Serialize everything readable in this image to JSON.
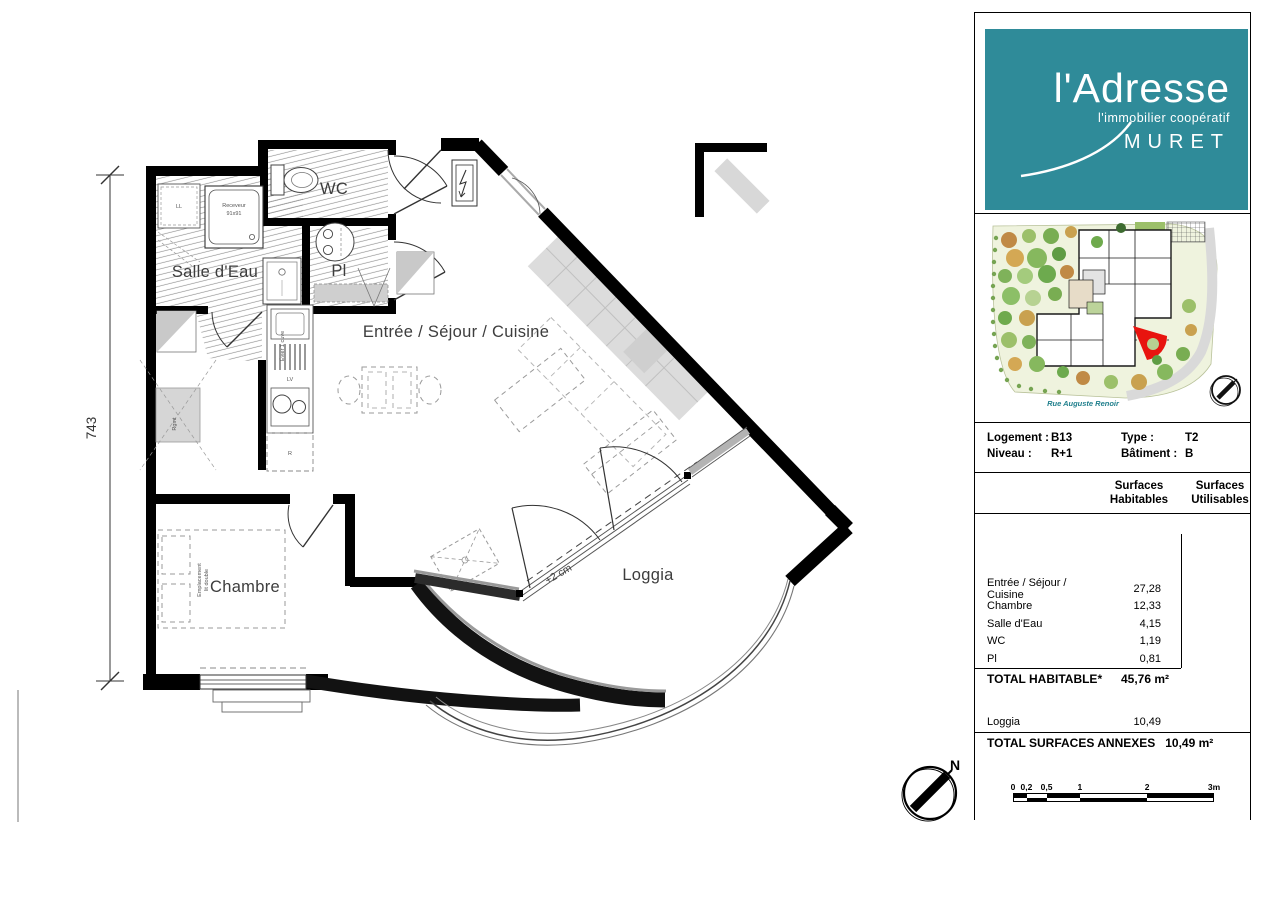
{
  "colors": {
    "brand_teal": "#2f8b99",
    "accent_red": "#e8140f",
    "street_teal": "#1f7f8c",
    "ink": "#000000",
    "label_gray": "#3d3d3d"
  },
  "plan": {
    "labels": {
      "salle_eau": "Salle d'Eau",
      "wc": "WC",
      "pl": "Pl",
      "sejour": "Entrée / Séjour / Cuisine",
      "chambre": "Chambre",
      "loggia": "Loggia",
      "loggia_offset": "+2 cm",
      "dim_height": "743",
      "north": "N"
    },
    "fixtures": {
      "shower_l1": "Receveur",
      "shower_l2": "91x91",
      "washer": "LL",
      "storage": "Rgmt",
      "sink": "Évier 1 cuve",
      "dishwasher": "LV",
      "fridge": "R",
      "bed_l1": "Emplacement",
      "bed_l2": "lit double"
    }
  },
  "sidebar": {
    "logo": {
      "brand": "l'Adresse",
      "tagline": "l'immobilier coopératif",
      "city": "MURET"
    },
    "siteplan": {
      "street": "Rue Auguste Renoir"
    },
    "info": {
      "logement_label": "Logement :",
      "logement_value": "B13",
      "type_label": "Type :",
      "type_value": "T2",
      "niveau_label": "Niveau :",
      "niveau_value": "R+1",
      "batiment_label": "Bâtiment :",
      "batiment_value": "B"
    },
    "surfaces": {
      "col1_l1": "Surfaces",
      "col1_l2": "Habitables",
      "col2_l1": "Surfaces",
      "col2_l2": "Utilisables",
      "rows": [
        {
          "label": "Entrée / Séjour / Cuisine",
          "value": "27,28"
        },
        {
          "label": "Chambre",
          "value": "12,33"
        },
        {
          "label": "Salle d'Eau",
          "value": "4,15"
        },
        {
          "label": "WC",
          "value": "1,19"
        },
        {
          "label": "Pl",
          "value": "0,81"
        }
      ],
      "total_label": "TOTAL HABITABLE*",
      "total_value": "45,76 m²",
      "annexe_row": {
        "label": "Loggia",
        "value": "10,49"
      },
      "annexes_total_label": "TOTAL SURFACES ANNEXES",
      "annexes_total_value": "10,49 m²"
    },
    "scalebar": {
      "ticks": [
        "0",
        "0,2",
        "0,5",
        "1",
        "2",
        "3m"
      ]
    }
  }
}
